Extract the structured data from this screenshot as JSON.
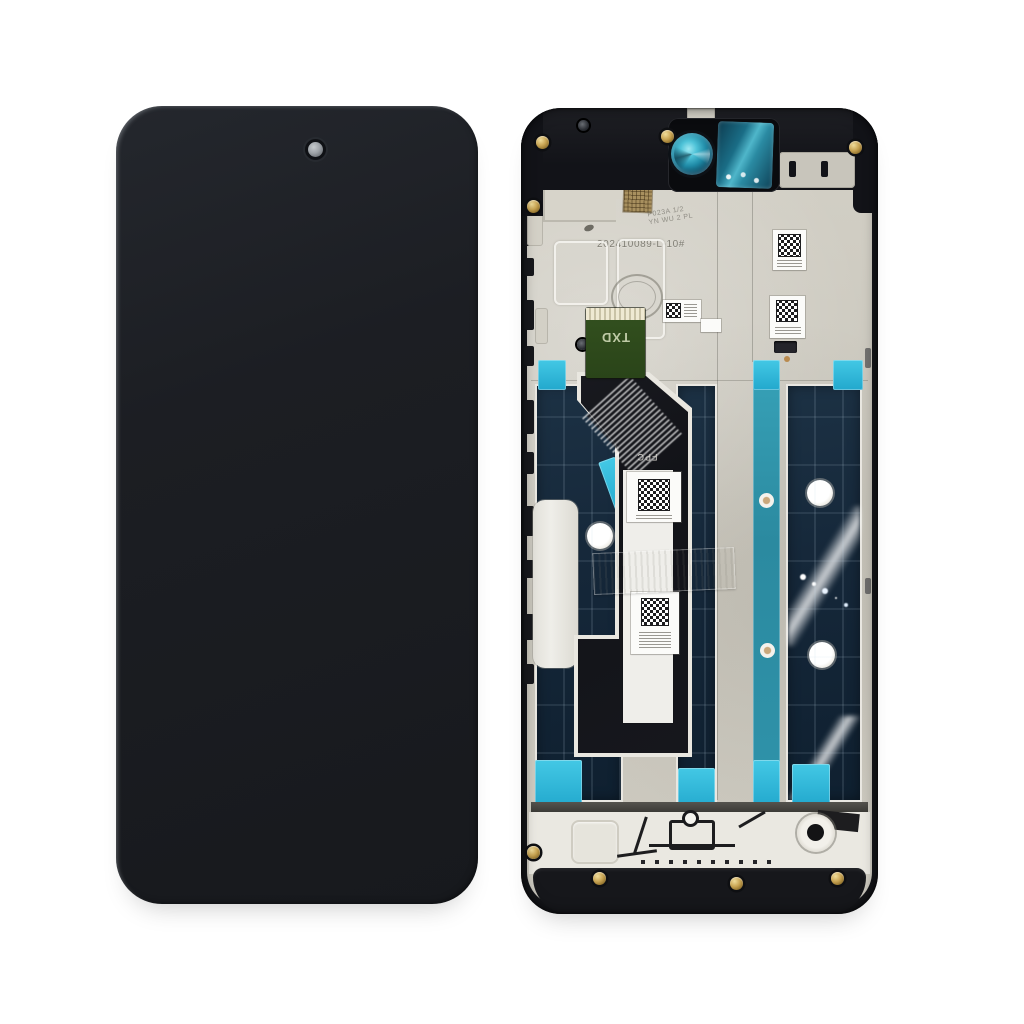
{
  "scene": {
    "background_color": "#ffffff",
    "subject": "Smartphone LCD screen assembly with frame — front panel and rear of chassis"
  },
  "front_panel": {
    "body_color": "#1b1d22",
    "camera_dot_color": "#9aa0a5"
  },
  "back_frame": {
    "labels": {
      "serial_number": "202410089-L-10#",
      "stamp_line1": "P023A 1/2",
      "stamp_line2": "YN WU 2 PL",
      "connector_label": "TXD",
      "flex_label": "FPC"
    },
    "colors": {
      "frame_black": "#15161a",
      "metal_plate": "#ccc9bf",
      "display_back_navy": "#152a3c",
      "adhesive_teal_strip": "#2e93ab",
      "adhesive_cyan": "#28b7dc",
      "camera_lens_teal": "#2fa9c4",
      "connector_green": "#31501e",
      "screw_gold": "#c2a24e"
    }
  }
}
